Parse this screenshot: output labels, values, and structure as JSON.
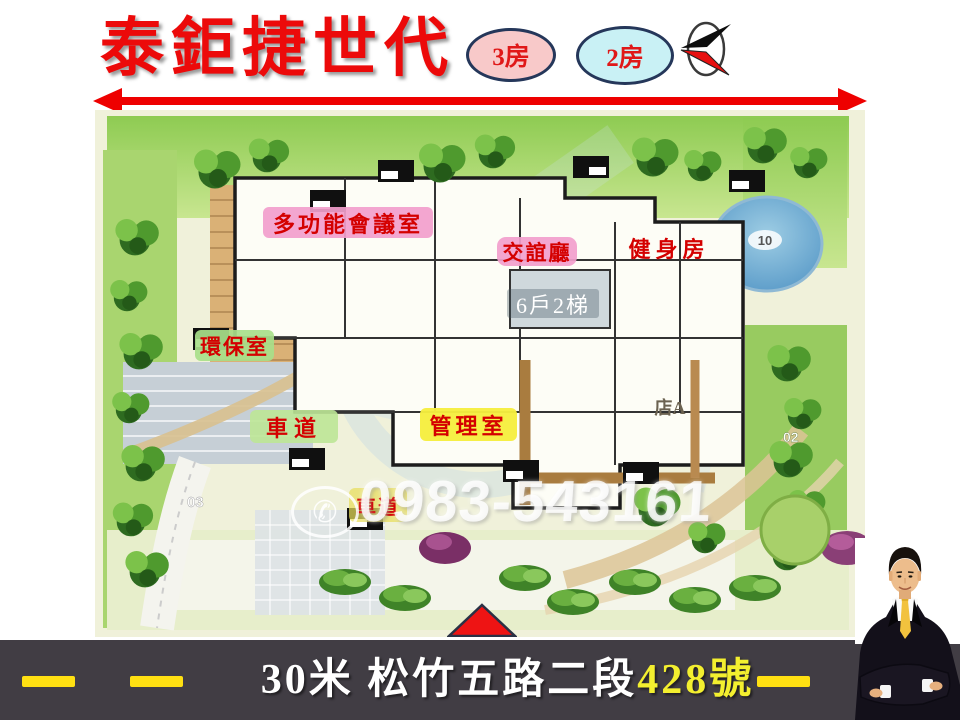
{
  "slide": {
    "title": "泰鉅捷世代",
    "badge_3room": "3房",
    "badge_2room": "2房"
  },
  "site_plan": {
    "label_meeting": "多功能會議室",
    "label_lounge": "交誼廳",
    "label_gym": "健身房",
    "unit_info": "6戶2梯",
    "label_recycle": "環保室",
    "label_drive_upper": "車道",
    "label_mgmt": "管理室",
    "label_drive_lower": "車道",
    "shop": "店A",
    "pool_number": "10",
    "lot_02": "02",
    "lot_03": "03",
    "phone_icon": "✆",
    "phone_watermark": "0983-543161"
  },
  "footer": {
    "address_road": "30米 松竹五路二段",
    "address_number": "428號"
  },
  "colors": {
    "title_red": "#ec0a0a",
    "badge3_fill": "#f8c9c9",
    "badge2_fill": "#c9f1f5",
    "label_pink": "#f29ecc",
    "label_green": "#a8e08a",
    "label_yellow": "#f6ee3e",
    "arrow_red": "#ee0000",
    "footer_bg": "#413d44",
    "dash_yellow": "#ffe012"
  }
}
